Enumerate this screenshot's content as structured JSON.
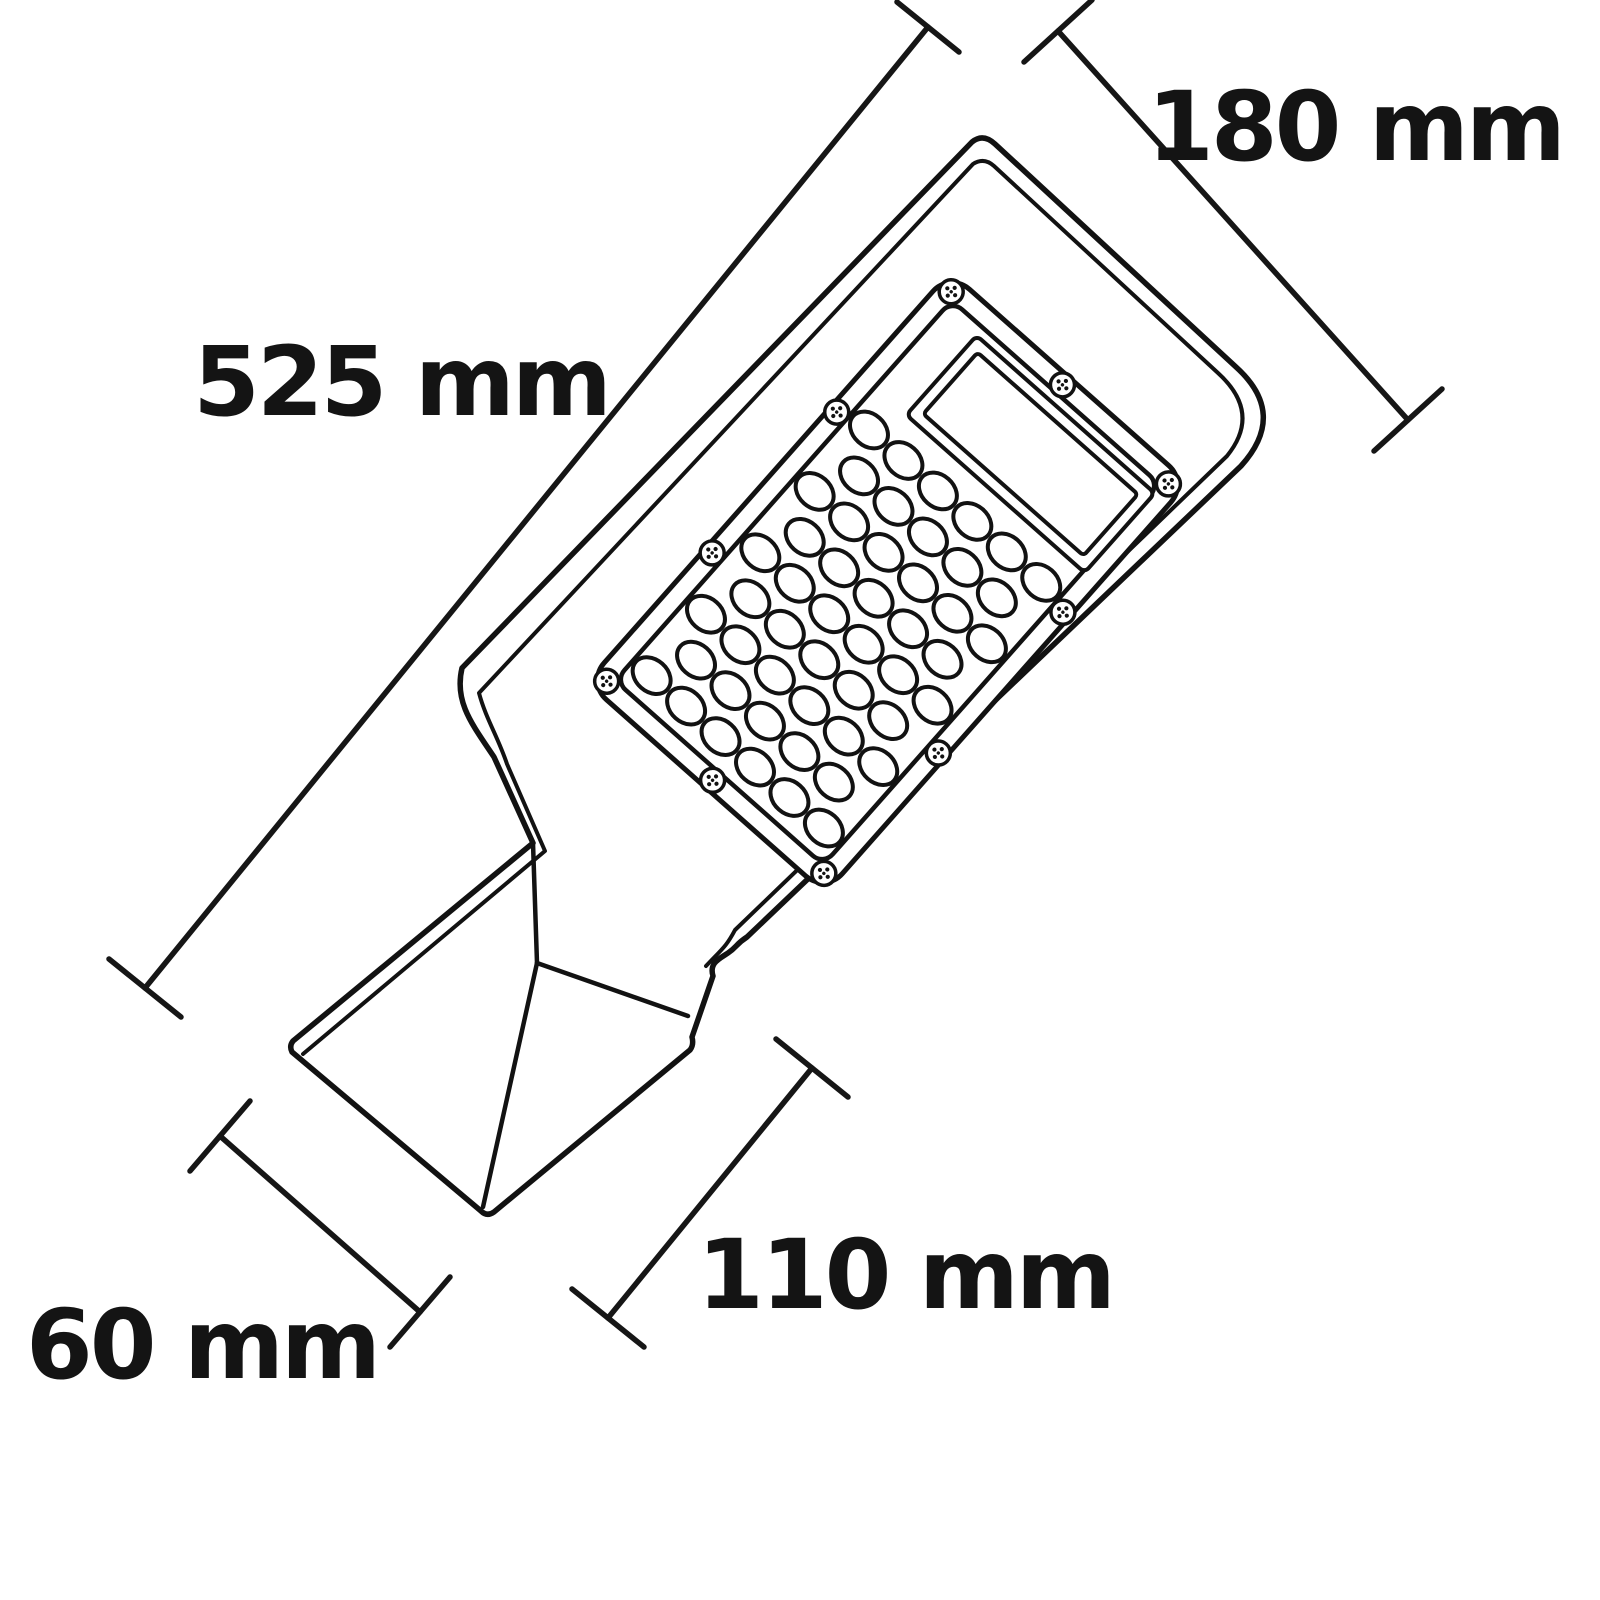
{
  "diagram": {
    "kind": "technical-dimension-drawing",
    "subject": "led-street-light",
    "background_color": "#ffffff",
    "line_color": "#121212",
    "led_grid": {
      "rows": 9,
      "row_pattern": [
        6,
        5
      ],
      "total_leds": 50
    },
    "screw_count": 10
  },
  "dimensions": {
    "body_length": {
      "label": "525 mm",
      "value": 525,
      "unit": "mm"
    },
    "head_width": {
      "label": "180 mm",
      "value": 180,
      "unit": "mm"
    },
    "mount_length": {
      "label": "110 mm",
      "value": 110,
      "unit": "mm"
    },
    "mount_diameter": {
      "label": "60 mm",
      "value": 60,
      "unit": "mm"
    }
  }
}
